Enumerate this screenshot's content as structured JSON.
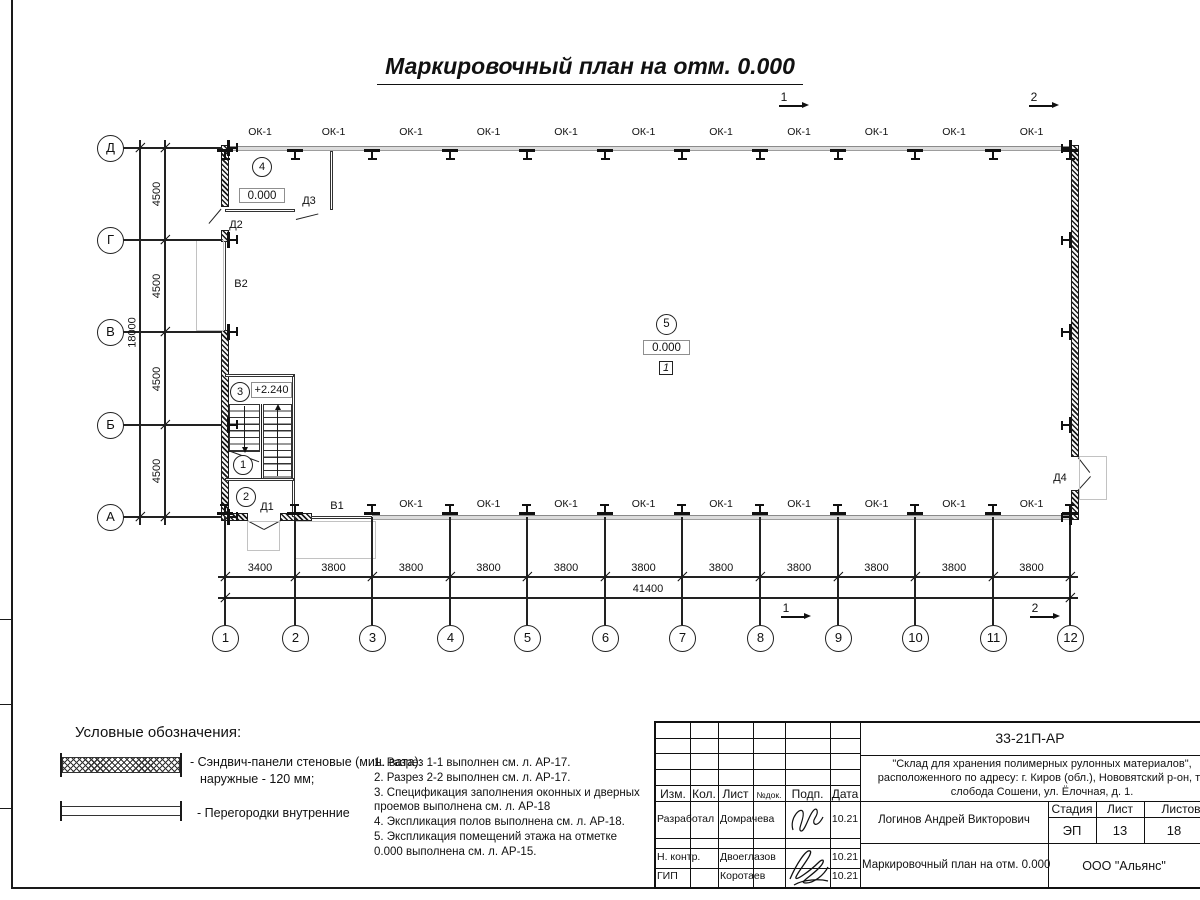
{
  "sheet": {
    "title": "Маркировочный план на отм. 0.000"
  },
  "plan": {
    "window_label": "ОК-1",
    "letter_axes": [
      "Д",
      "Г",
      "В",
      "Б",
      "А"
    ],
    "number_axes": [
      "1",
      "2",
      "3",
      "4",
      "5",
      "6",
      "7",
      "8",
      "9",
      "10",
      "11",
      "12"
    ],
    "v_dims": [
      "4500",
      "4500",
      "4500",
      "4500"
    ],
    "v_total": "18000",
    "h_dims": [
      "3400",
      "3800",
      "3800",
      "3800",
      "3800",
      "3800",
      "3800",
      "3800",
      "3800",
      "3800",
      "3800"
    ],
    "h_total": "41400",
    "rooms": {
      "r1": "1",
      "r2": "2",
      "r3": "3",
      "r4": "4",
      "r5": "5"
    },
    "elev_zero": "0.000",
    "elev_upper": "+2.240",
    "floor_mark": "1",
    "doors": {
      "d1": "Д1",
      "d2": "Д2",
      "d3": "Д3",
      "d4": "Д4"
    },
    "partitions": {
      "v1": "В1",
      "v2": "В2"
    },
    "sections": {
      "s1": "1",
      "s2": "2"
    }
  },
  "legend": {
    "heading": "Условные обозначения:",
    "items": [
      {
        "label1": "- Сэндвич-панели стеновые (мин. вата):",
        "label2": "наружные - 120 мм;"
      },
      {
        "label1": "- Перегородки внутренние"
      }
    ]
  },
  "notes": [
    "1. Разрез 1-1 выполнен см. л. АР-17.",
    "2. Разрез 2-2 выполнен см. л. АР-17.",
    "3. Спецификация заполнения оконных и дверных",
    "проемов выполнена см. л. АР-18",
    "4. Экспликация полов выполнена см. л. АР-18.",
    "5. Экспликация помещений этажа на отметке",
    "0.000 выполнена см. л. АР-15."
  ],
  "titleblock": {
    "doc_number": "33-21П-АР",
    "project_line1": "\"Склад для хранения полимерных рулонных материалов\",",
    "project_line2": "расположенного по адресу: г. Киров (обл.), Нововятский р-он, те",
    "project_line3": "слобода Сошени, ул. Ёлочная, д. 1.",
    "header": [
      "Изм.",
      "Кол.",
      "Лист",
      "№док.",
      "Подп.",
      "Дата"
    ],
    "rows": [
      {
        "role": "Разработал",
        "name": "Домрачева",
        "date": "10.21"
      },
      {
        "role": "Н. контр.",
        "name": "Двоеглазов",
        "date": "10.21"
      },
      {
        "role": "ГИП",
        "name": "Коротаев",
        "date": "10.21"
      }
    ],
    "chief": "Логинов Андрей Викторович",
    "stage_label": "Стадия",
    "sheet_label": "Лист",
    "sheets_label": "Листов",
    "stage": "ЭП",
    "sheet_num": "13",
    "sheets_total": "18",
    "drawing_name": "Маркировочный план на отм. 0.000",
    "company": "ООО \"Альянс\""
  }
}
